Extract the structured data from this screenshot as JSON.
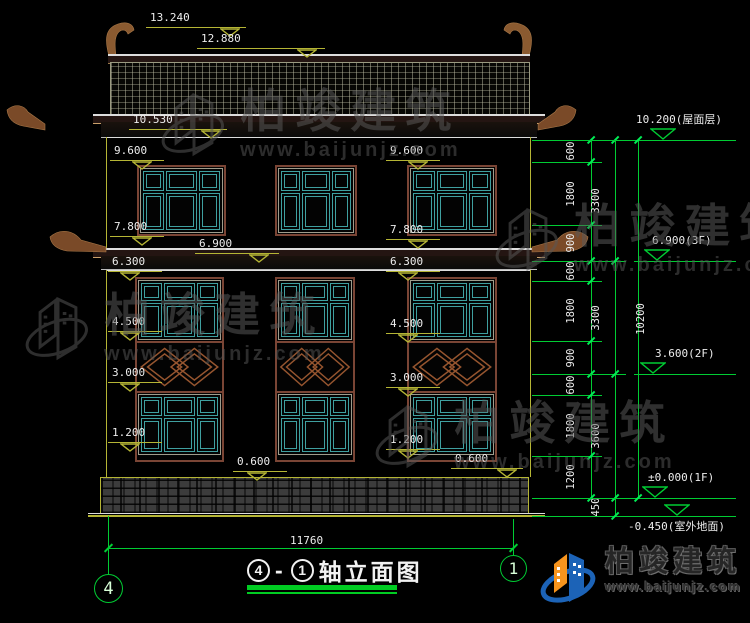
{
  "colors": {
    "background": "#000000",
    "dimension_green": "#00cc33",
    "level_olive": "#b5b535",
    "window_teal": "#3fa0a0",
    "frame_brown": "#7a4535",
    "ornament_brown": "#8a5a30",
    "text_white": "#ececec",
    "watermark_gray": "#5a5a5a",
    "logo_blue": "#1c63b7",
    "logo_orange": "#f7941d"
  },
  "elevation_labels_left": [
    {
      "text": "13.240",
      "x": 150,
      "y": 12,
      "w": 100,
      "tdx": 74
    },
    {
      "text": "12.880",
      "x": 201,
      "y": 33,
      "w": 128,
      "tdx": 100
    },
    {
      "text": "10.530",
      "x": 133,
      "y": 114,
      "w": 98,
      "tdx": 72
    },
    {
      "text": "9.600",
      "x": 114,
      "y": 145,
      "w": 54,
      "tdx": 22
    },
    {
      "text": "7.800",
      "x": 114,
      "y": 221,
      "w": 54,
      "tdx": 22
    },
    {
      "text": "6.900",
      "x": 199,
      "y": 238,
      "w": 84,
      "tdx": 54
    },
    {
      "text": "6.300",
      "x": 112,
      "y": 256,
      "w": 54,
      "tdx": 12
    },
    {
      "text": "4.500",
      "x": 112,
      "y": 316,
      "w": 54,
      "tdx": 12
    },
    {
      "text": "3.000",
      "x": 112,
      "y": 367,
      "w": 54,
      "tdx": 12
    },
    {
      "text": "1.200",
      "x": 112,
      "y": 427,
      "w": 54,
      "tdx": 12
    },
    {
      "text": "9.600",
      "x": 390,
      "y": 145,
      "w": 54,
      "tdx": 22
    },
    {
      "text": "7.800",
      "x": 390,
      "y": 224,
      "w": 54,
      "tdx": 22
    },
    {
      "text": "6.300",
      "x": 390,
      "y": 256,
      "w": 54,
      "tdx": 12
    },
    {
      "text": "4.500",
      "x": 390,
      "y": 318,
      "w": 54,
      "tdx": 12
    },
    {
      "text": "3.000",
      "x": 390,
      "y": 372,
      "w": 54,
      "tdx": 12
    },
    {
      "text": "1.200",
      "x": 390,
      "y": 434,
      "w": 54,
      "tdx": 12
    },
    {
      "text": "0.600",
      "x": 237,
      "y": 456,
      "w": 54,
      "tdx": 14
    },
    {
      "text": "0.600",
      "x": 455,
      "y": 453,
      "w": 72,
      "tdx": 46
    }
  ],
  "elevation_labels_right": [
    {
      "text": "10.200(屋面层)",
      "level": 140,
      "lx1": 610,
      "lx2": 736,
      "trix": 650,
      "tx": 636,
      "below": false
    },
    {
      "text": "6.900(3F)",
      "level": 261,
      "lx1": 634,
      "lx2": 736,
      "trix": 644,
      "tx": 652,
      "below": false
    },
    {
      "text": "3.600(2F)",
      "level": 374,
      "lx1": 634,
      "lx2": 736,
      "trix": 640,
      "tx": 655,
      "below": false
    },
    {
      "text": "±0.000(1F)",
      "level": 498,
      "lx1": 634,
      "lx2": 736,
      "trix": 642,
      "tx": 648,
      "below": false
    },
    {
      "text": "-0.450(室外地面)",
      "level": 516,
      "lx1": 618,
      "lx2": 736,
      "trix": 664,
      "tx": 628,
      "below": true
    }
  ],
  "dimension_chains": [
    {
      "x": 591,
      "value_x": 578,
      "tick_x1": 532,
      "tick_x2": 602,
      "ticks": [
        140,
        162,
        225,
        261,
        281,
        341,
        374,
        395,
        456,
        498
      ],
      "values": [
        "600",
        "1800",
        "900",
        "600",
        "1800",
        "900",
        "600",
        "1800",
        "1200"
      ]
    },
    {
      "x": 615,
      "value_x": 603,
      "tick_x1": 532,
      "tick_x2": 626,
      "ticks": [
        140,
        261,
        374,
        498,
        516
      ],
      "values": [
        "3300",
        "3300",
        "3600",
        "450"
      ]
    },
    {
      "x": 638,
      "value_x": 648,
      "tick_x1": 532,
      "tick_x2": 650,
      "ticks": [
        140,
        498
      ],
      "values": [
        "10200"
      ]
    }
  ],
  "bottom_dimension": {
    "text": "11760"
  },
  "axis_bubbles": {
    "left": "4",
    "right": "1"
  },
  "drawing_title": {
    "prefix_axis": "4",
    "separator": "-",
    "suffix_axis": "1",
    "text": "轴立面图"
  },
  "watermarks": [
    {
      "text": "柏竣建筑",
      "url": "www.baijunjz.com",
      "x": 158,
      "y": 88
    },
    {
      "text": "柏竣建筑",
      "url": "www.baijunjz.com",
      "x": 22,
      "y": 292
    },
    {
      "text": "柏竣建筑",
      "url": "www.baijunjz.com",
      "x": 492,
      "y": 203
    },
    {
      "text": "柏竣建筑",
      "url": "www.baijunjz.com",
      "x": 372,
      "y": 400
    }
  ],
  "logo": {
    "company": "柏竣建筑",
    "url": "www.baijunjz.com"
  }
}
